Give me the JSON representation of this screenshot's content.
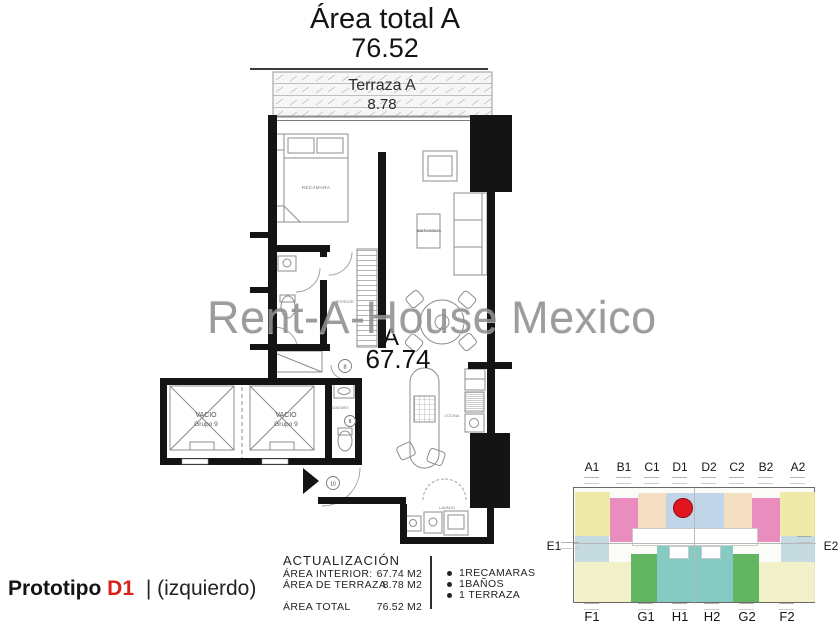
{
  "header": {
    "title": "Área total A",
    "total_value": "76.52"
  },
  "watermark": "Rent-A-House Mexico",
  "plan": {
    "terrace_label": "Terraza A",
    "terrace_value": "8.78",
    "unit_letter": "A",
    "unit_area": "67.74",
    "rooms": {
      "bedroom": "RECÁMARA",
      "living": "ESTANCIA",
      "dressing": "VESTIDOR",
      "bathroom": "SANITARIO",
      "kitchen": "COCINA",
      "laundry": "LAVADO"
    },
    "voids": [
      {
        "line1": "VACIO",
        "line2": "Grupo 9"
      },
      {
        "line1": "VACIO",
        "line2": "Grupo 9"
      }
    ],
    "door_tags": [
      "8",
      "8",
      "10"
    ]
  },
  "footer": {
    "prototype": {
      "label": "Prototipo",
      "code": "D1",
      "side": "| (izquierdo)"
    },
    "update": {
      "title": "ACTUALIZACIÓN",
      "rows": [
        {
          "label": "ÁREA INTERIOR:",
          "value": "67.74 M2"
        },
        {
          "label": "ÁREA DE TERRAZA",
          "value": "8.78 M2"
        },
        {
          "label": "ÁREA TOTAL",
          "value": "76.52 M2"
        }
      ]
    },
    "features": [
      "1RECAMARAS",
      "1BAÑOS",
      "1 TERRAZA"
    ]
  },
  "keyplan": {
    "top_units": [
      "A1",
      "B1",
      "C1",
      "D1",
      "D2",
      "C2",
      "B2",
      "A2"
    ],
    "side_units": [
      "E1",
      "E2"
    ],
    "bottom_units": [
      "F1",
      "G1",
      "H1",
      "H2",
      "G2",
      "F2"
    ],
    "highlighted_unit": "D1",
    "marker_color": "#e0151d",
    "unit_colors": {
      "A": "#efe9a3",
      "B": "#e887ba",
      "C": "#f4ddbf",
      "D": "#bdd3e7",
      "E": "#c3d9dd",
      "F": "#f1efc6",
      "G": "#5ab158",
      "H": "#80c8c0"
    }
  },
  "colors": {
    "prototype_code_red": "#d8201c",
    "wall_black": "#141414",
    "watermark_gray": "#8f8f8f"
  }
}
